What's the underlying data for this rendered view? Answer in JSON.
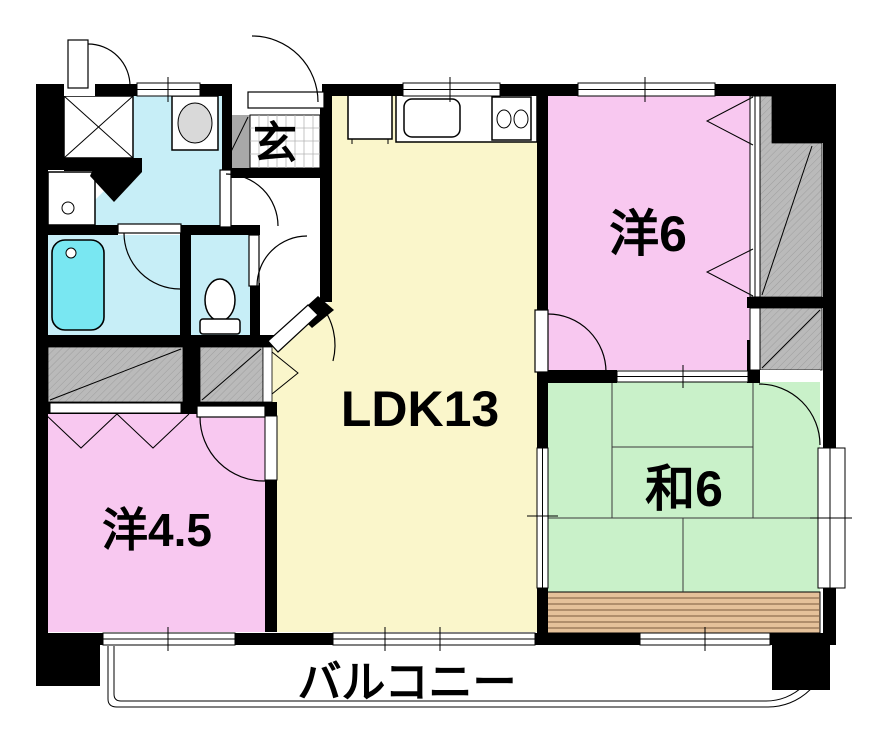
{
  "rooms": {
    "genkan": {
      "label": "玄"
    },
    "ldk": {
      "label": "LDK13"
    },
    "western6": {
      "label": "洋6"
    },
    "western45": {
      "label": "洋4.5"
    },
    "japanese6": {
      "label": "和6"
    },
    "balcony": {
      "label": "バルコニー"
    }
  },
  "fixtures": [
    "bathtub",
    "toilet",
    "washbasin",
    "vanity-cabinet",
    "washing-machine-pan",
    "kitchen-sink",
    "gas-stove",
    "refrigerator",
    "closets",
    "engawa-wood-strip",
    "bay-window"
  ],
  "colors": {
    "wall": "#000000",
    "ldk": "#FAF6CB",
    "western": "#F8C8F0",
    "japanese": "#C9F1C9",
    "water": "#C7EEF7",
    "tub": "#79E7F2",
    "wood": "#E5C19A",
    "closet": "#BABABA",
    "slope": "#A8A8A8",
    "basin": "#D9D9D9"
  }
}
